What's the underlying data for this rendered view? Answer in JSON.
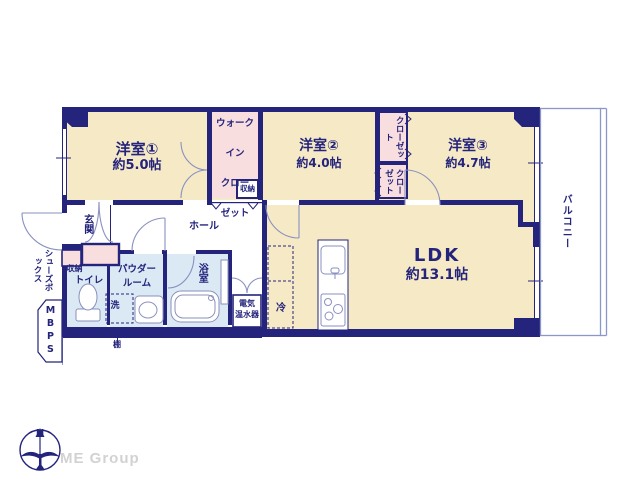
{
  "floorplan": {
    "rooms": {
      "room1": {
        "name": "洋室①",
        "area": "約5.0帖"
      },
      "room2": {
        "name": "洋室②",
        "area": "約4.0帖"
      },
      "room3": {
        "name": "洋室③",
        "area": "約4.7帖"
      },
      "ldk": {
        "name": "LDK",
        "area": "約13.1帖"
      }
    },
    "closets": {
      "wic_line1": "ウォーク",
      "wic_line2": "イン",
      "wic_line3": "クロー",
      "wic_line4": "ゼット",
      "wic_storage": "収納",
      "closet_top": "クローゼット",
      "closet_bottom": "クローゼット"
    },
    "spaces": {
      "balcony": "バルコニー",
      "entrance": "玄関",
      "hall": "ホール",
      "entrance_storage": "収納",
      "toilet": "トイレ",
      "powder_line1": "パウダー",
      "powder_line2": "ルーム",
      "washer": "洗",
      "bath": "浴室",
      "heater_line1": "電気",
      "heater_line2": "温水器",
      "fridge": "冷",
      "shoes_box": "シューズボックス",
      "pipe_space": "MBPS",
      "shelf": "棚"
    },
    "compass": {
      "north": "N"
    },
    "branding": {
      "logo": "ME Group"
    },
    "colors": {
      "wall": "#24247c",
      "room_floor": "#f6eac6",
      "closet_fill": "#f8dede",
      "wet_area": "#dbe9f5",
      "fixture_line": "#8a90bf",
      "balcony_line": "#8d96c8",
      "logo_gray": "#d2d2d2"
    }
  }
}
